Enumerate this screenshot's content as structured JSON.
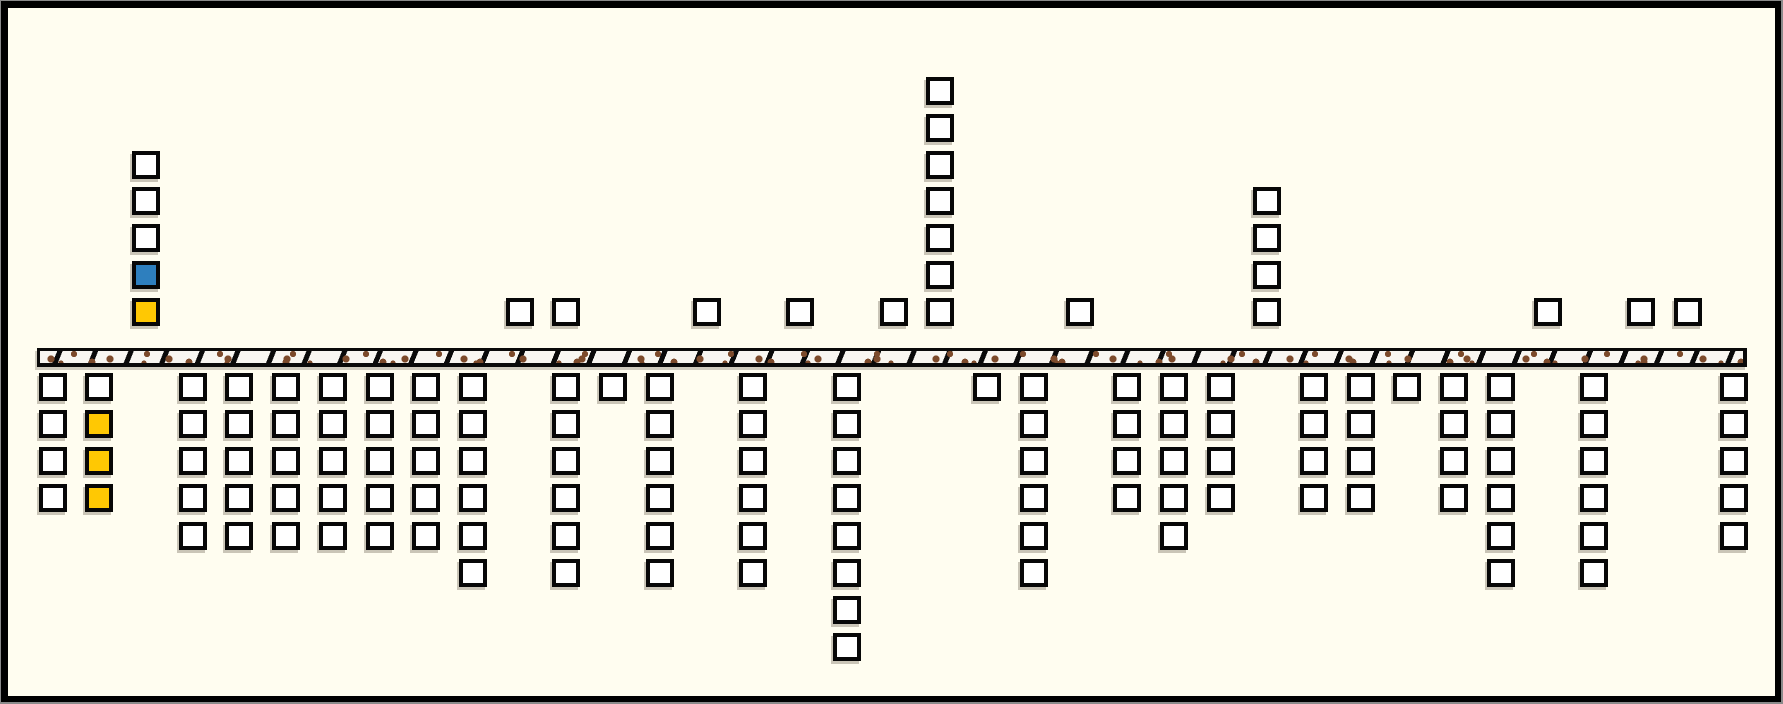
{
  "board": {
    "background_color": "#FFFDF0",
    "frame_color": "#000000",
    "tile_colors": {
      "white": "#FFFFFF",
      "blue": "#2E7FBE",
      "gold": "#FFC803"
    },
    "ground": {
      "fill_color": "#F8F6F1",
      "border_color": "#0A0A0A",
      "dot_color": "#7C4A2B",
      "hatch_color": "#0A0A0A"
    },
    "columns": [
      {
        "index": 0,
        "above": [],
        "below": [
          "white",
          "white",
          "white",
          "white"
        ]
      },
      {
        "index": 1,
        "above": [],
        "below": [
          "white",
          "gold",
          "gold",
          "gold"
        ]
      },
      {
        "index": 2,
        "above": [
          "gold",
          "blue",
          "white",
          "white",
          "white"
        ],
        "below": []
      },
      {
        "index": 3,
        "above": [],
        "below": [
          "white",
          "white",
          "white",
          "white",
          "white"
        ]
      },
      {
        "index": 4,
        "above": [],
        "below": [
          "white",
          "white",
          "white",
          "white",
          "white"
        ]
      },
      {
        "index": 5,
        "above": [],
        "below": [
          "white",
          "white",
          "white",
          "white",
          "white"
        ]
      },
      {
        "index": 6,
        "above": [],
        "below": [
          "white",
          "white",
          "white",
          "white",
          "white"
        ]
      },
      {
        "index": 7,
        "above": [],
        "below": [
          "white",
          "white",
          "white",
          "white",
          "white"
        ]
      },
      {
        "index": 8,
        "above": [],
        "below": [
          "white",
          "white",
          "white",
          "white",
          "white"
        ]
      },
      {
        "index": 9,
        "above": [],
        "below": [
          "white",
          "white",
          "white",
          "white",
          "white",
          "white"
        ]
      },
      {
        "index": 10,
        "above": [
          "white"
        ],
        "below": []
      },
      {
        "index": 11,
        "above": [
          "white"
        ],
        "below": [
          "white",
          "white",
          "white",
          "white",
          "white",
          "white"
        ]
      },
      {
        "index": 12,
        "above": [],
        "below": [
          "white"
        ]
      },
      {
        "index": 13,
        "above": [],
        "below": [
          "white",
          "white",
          "white",
          "white",
          "white",
          "white"
        ]
      },
      {
        "index": 14,
        "above": [
          "white"
        ],
        "below": []
      },
      {
        "index": 15,
        "above": [],
        "below": [
          "white",
          "white",
          "white",
          "white",
          "white",
          "white"
        ]
      },
      {
        "index": 16,
        "above": [
          "white"
        ],
        "below": []
      },
      {
        "index": 17,
        "above": [],
        "below": [
          "white",
          "white",
          "white",
          "white",
          "white",
          "white",
          "white",
          "white"
        ]
      },
      {
        "index": 18,
        "above": [
          "white"
        ],
        "below": []
      },
      {
        "index": 19,
        "above": [
          "white",
          "white",
          "white",
          "white",
          "white",
          "white",
          "white"
        ],
        "below": []
      },
      {
        "index": 20,
        "above": [],
        "below": [
          "white"
        ]
      },
      {
        "index": 21,
        "above": [],
        "below": [
          "white",
          "white",
          "white",
          "white",
          "white",
          "white"
        ]
      },
      {
        "index": 22,
        "above": [
          "white"
        ],
        "below": []
      },
      {
        "index": 23,
        "above": [],
        "below": [
          "white",
          "white",
          "white",
          "white"
        ]
      },
      {
        "index": 24,
        "above": [],
        "below": [
          "white",
          "white",
          "white",
          "white",
          "white"
        ]
      },
      {
        "index": 25,
        "above": [],
        "below": [
          "white",
          "white",
          "white",
          "white"
        ]
      },
      {
        "index": 26,
        "above": [
          "white",
          "white",
          "white",
          "white"
        ],
        "below": []
      },
      {
        "index": 27,
        "above": [],
        "below": [
          "white",
          "white",
          "white",
          "white"
        ]
      },
      {
        "index": 28,
        "above": [],
        "below": [
          "white",
          "white",
          "white",
          "white"
        ]
      },
      {
        "index": 29,
        "above": [],
        "below": [
          "white"
        ]
      },
      {
        "index": 30,
        "above": [],
        "below": [
          "white",
          "white",
          "white",
          "white"
        ]
      },
      {
        "index": 31,
        "above": [],
        "below": [
          "white",
          "white",
          "white",
          "white",
          "white",
          "white"
        ]
      },
      {
        "index": 32,
        "above": [
          "white"
        ],
        "below": []
      },
      {
        "index": 33,
        "above": [],
        "below": [
          "white",
          "white",
          "white",
          "white",
          "white",
          "white"
        ]
      },
      {
        "index": 34,
        "above": [
          "white"
        ],
        "below": []
      },
      {
        "index": 35,
        "above": [
          "white"
        ],
        "below": []
      },
      {
        "index": 36,
        "above": [],
        "below": [
          "white",
          "white",
          "white",
          "white",
          "white"
        ]
      }
    ]
  }
}
